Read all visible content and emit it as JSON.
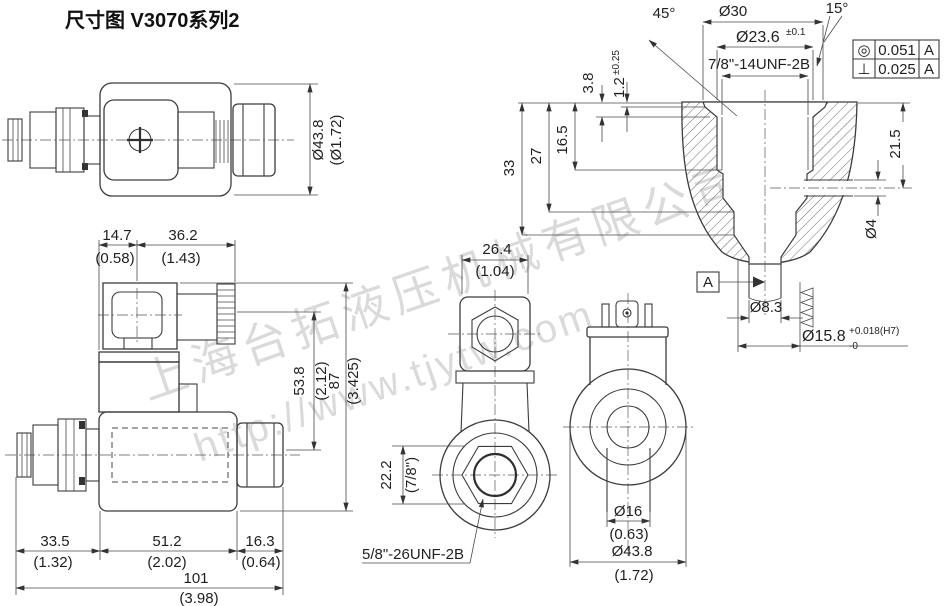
{
  "title": "尺寸图 V3070系列2",
  "watermark": {
    "company": "上海台拓液压机械有限公司",
    "url": "http://www.tjytw.com"
  },
  "tol_frame": {
    "sym1": "◎",
    "val1": "0.051",
    "dat1": "A",
    "sym2": "⊥",
    "val2": "0.025",
    "dat2": "A"
  },
  "cavity": {
    "a45": "45°",
    "d30": "Ø30",
    "a15": "15°",
    "d236": "Ø23.6",
    "d236t": "±0.1",
    "thread": "7/8\"-14UNF-2B",
    "d38": "3.8",
    "d12": "1.2",
    "d12t": "±0.25",
    "d165": "16.5",
    "d27": "27",
    "d33": "33",
    "d215": "21.5",
    "d4": "Ø4",
    "datum": "A",
    "d83": "Ø8.3",
    "d158": "Ø15.8",
    "d158sup": "+0.018(H7)",
    "d158sub": "-0"
  },
  "view_top": {
    "d438": "Ø43.8",
    "d438in": "(Ø1.72)"
  },
  "view_front": {
    "w147": "14.7",
    "w147in": "(0.58)",
    "w362": "36.2",
    "w362in": "(1.43)",
    "h538": "53.8",
    "h538in": "(2.12)",
    "h87": "87",
    "h87in": "(3.425)",
    "w335": "33.5",
    "w335in": "(1.32)",
    "w512": "51.2",
    "w512in": "(2.02)",
    "w163": "16.3",
    "w163in": "(0.64)",
    "w101": "101",
    "w101in": "(3.98)"
  },
  "view_bottom": {
    "w264": "26.4",
    "w264in": "(1.04)",
    "h222": "22.2",
    "h222in": "(7/8\")",
    "thread": "5/8\"-26UNF-2B"
  },
  "view_coil": {
    "d16": "Ø16",
    "d16in": "(0.63)",
    "d438": "Ø43.8",
    "d438in": "(1.72)"
  }
}
